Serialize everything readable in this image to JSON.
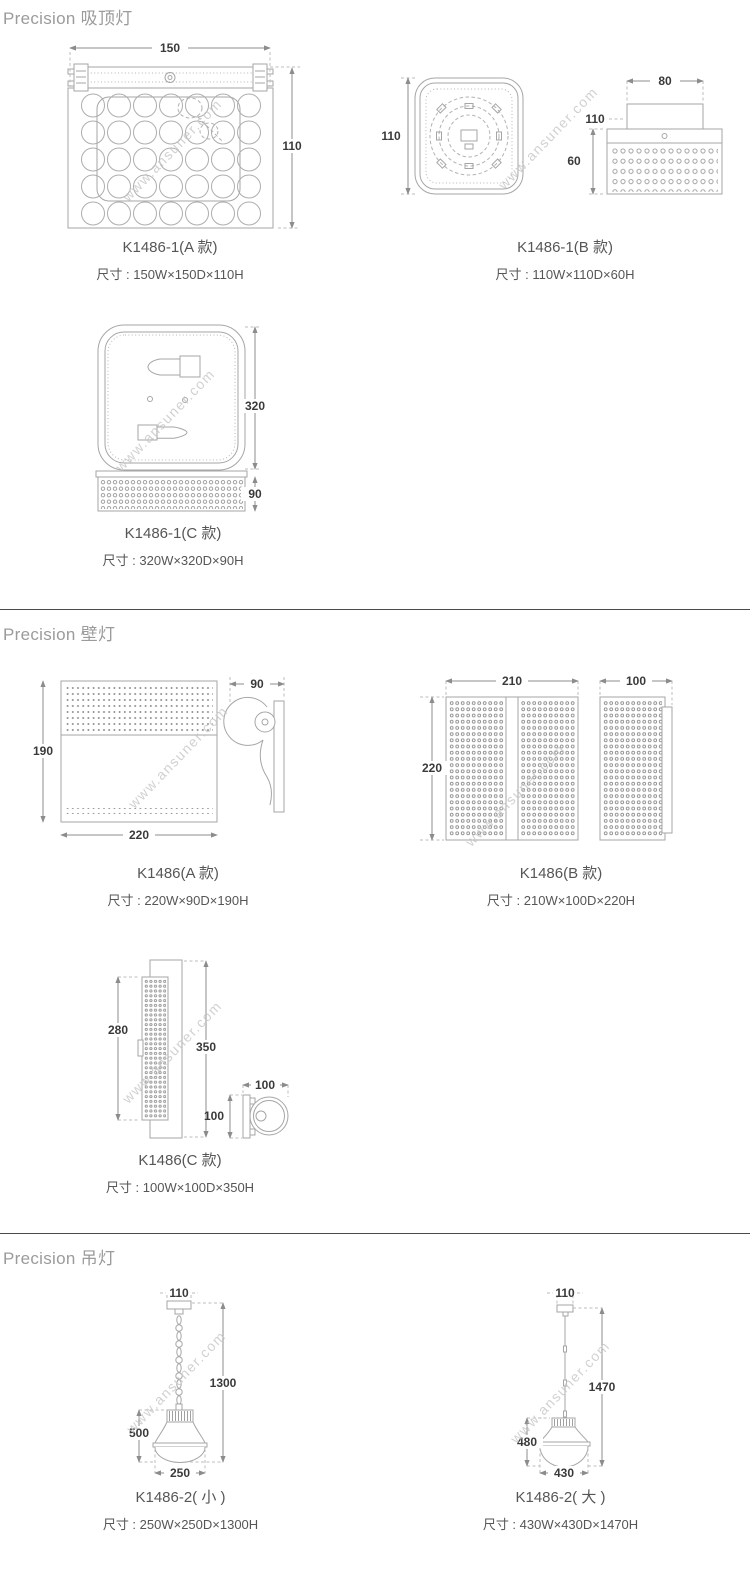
{
  "watermark": "www.ansuner.com",
  "colors": {
    "line": "#a6a6a6",
    "dimension_text": "#3a3a3a",
    "caption_text": "#565656",
    "heading_text": "#9b9b9b",
    "watermark_text": "#c6c6c6",
    "divider": "#4a4a4a"
  },
  "sections": {
    "ceiling": {
      "heading": "Precision 吸顶灯",
      "a": {
        "model": "K1486-1(A 款)",
        "size": "尺寸 : 150W×150D×110H",
        "dims": {
          "w": "150",
          "h": "110"
        }
      },
      "b": {
        "model": "K1486-1(B 款)",
        "size": "尺寸 : 110W×110D×60H",
        "dims": {
          "plan": "110",
          "top": "80",
          "cap": "110",
          "height": "60"
        }
      },
      "c": {
        "model": "K1486-1(C 款)",
        "size": "尺寸 : 320W×320D×90H",
        "dims": {
          "h": "320",
          "base": "90"
        }
      }
    },
    "wall": {
      "heading": "Precision 壁灯",
      "a": {
        "model": "K1486(A 款)",
        "size": "尺寸 : 220W×90D×190H",
        "dims": {
          "h": "190",
          "w": "220",
          "d": "90"
        }
      },
      "b": {
        "model": "K1486(B 款)",
        "size": "尺寸 : 210W×100D×220H",
        "dims": {
          "w": "210",
          "h": "220",
          "d": "100"
        }
      },
      "c": {
        "model": "K1486(C 款)",
        "size": "尺寸 : 100W×100D×350H",
        "dims": {
          "panel": "280",
          "h": "350",
          "top": "100",
          "side": "100"
        }
      }
    },
    "pendant": {
      "heading": "Precision 吊灯",
      "small": {
        "model": "K1486-2( 小 )",
        "size": "尺寸 : 250W×250D×1300H",
        "dims": {
          "canopy": "110",
          "total": "1300",
          "lamp": "500",
          "w": "250"
        }
      },
      "large": {
        "model": "K1486-2( 大 )",
        "size": "尺寸 : 430W×430D×1470H",
        "dims": {
          "canopy": "110",
          "total": "1470",
          "lamp": "480",
          "w": "430"
        }
      }
    }
  }
}
